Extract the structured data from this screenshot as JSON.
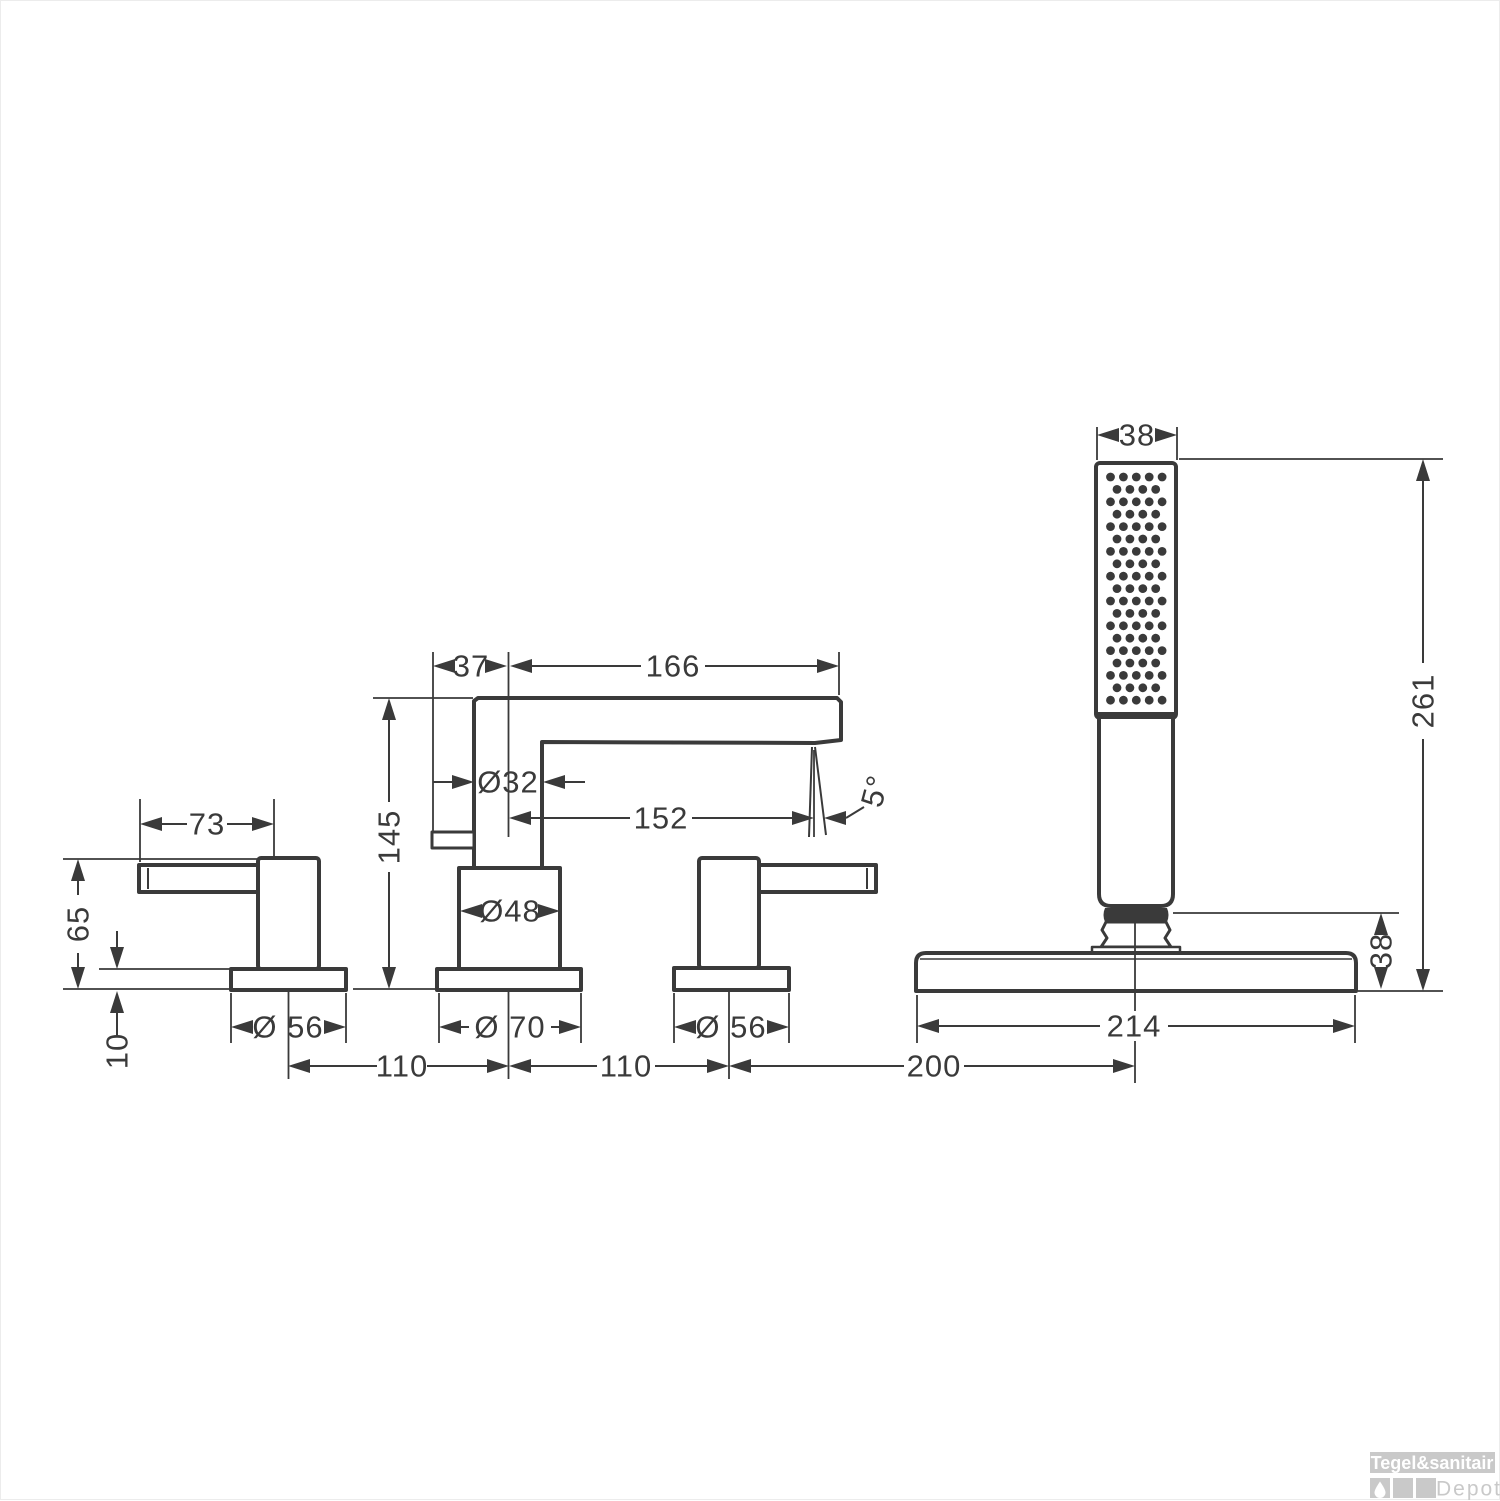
{
  "figure": {
    "type": "technical-dimension-drawing",
    "subject": "4-hole rim-mounted bath mixer with hand shower",
    "units": "mm",
    "line_color": "#3a3a3a",
    "dims": {
      "lever_length": "73",
      "handle_height": "65",
      "escutcheon_height": "10",
      "handle_escutcheon_dia_left": "Ø 56",
      "spacing_left": "110",
      "spout_back_offset": "37",
      "spout_reach": "166",
      "spout_pipe_dia": "Ø32",
      "outlet_reach": "152",
      "outlet_angle": "5°",
      "spout_height": "145",
      "spout_body_dia": "Ø48",
      "spout_escutcheon_dia": "Ø 70",
      "spacing_right": "110",
      "handle_escutcheon_dia_right": "Ø 56",
      "spacing_shower": "200",
      "handshower_width": "38",
      "handshower_height": "261",
      "holder_height": "38",
      "shower_plate_dia": "214"
    }
  },
  "watermark": {
    "brand": "Tegel&sanitair",
    "sub": "Depot",
    "bar_color": "#c9c9c9"
  }
}
